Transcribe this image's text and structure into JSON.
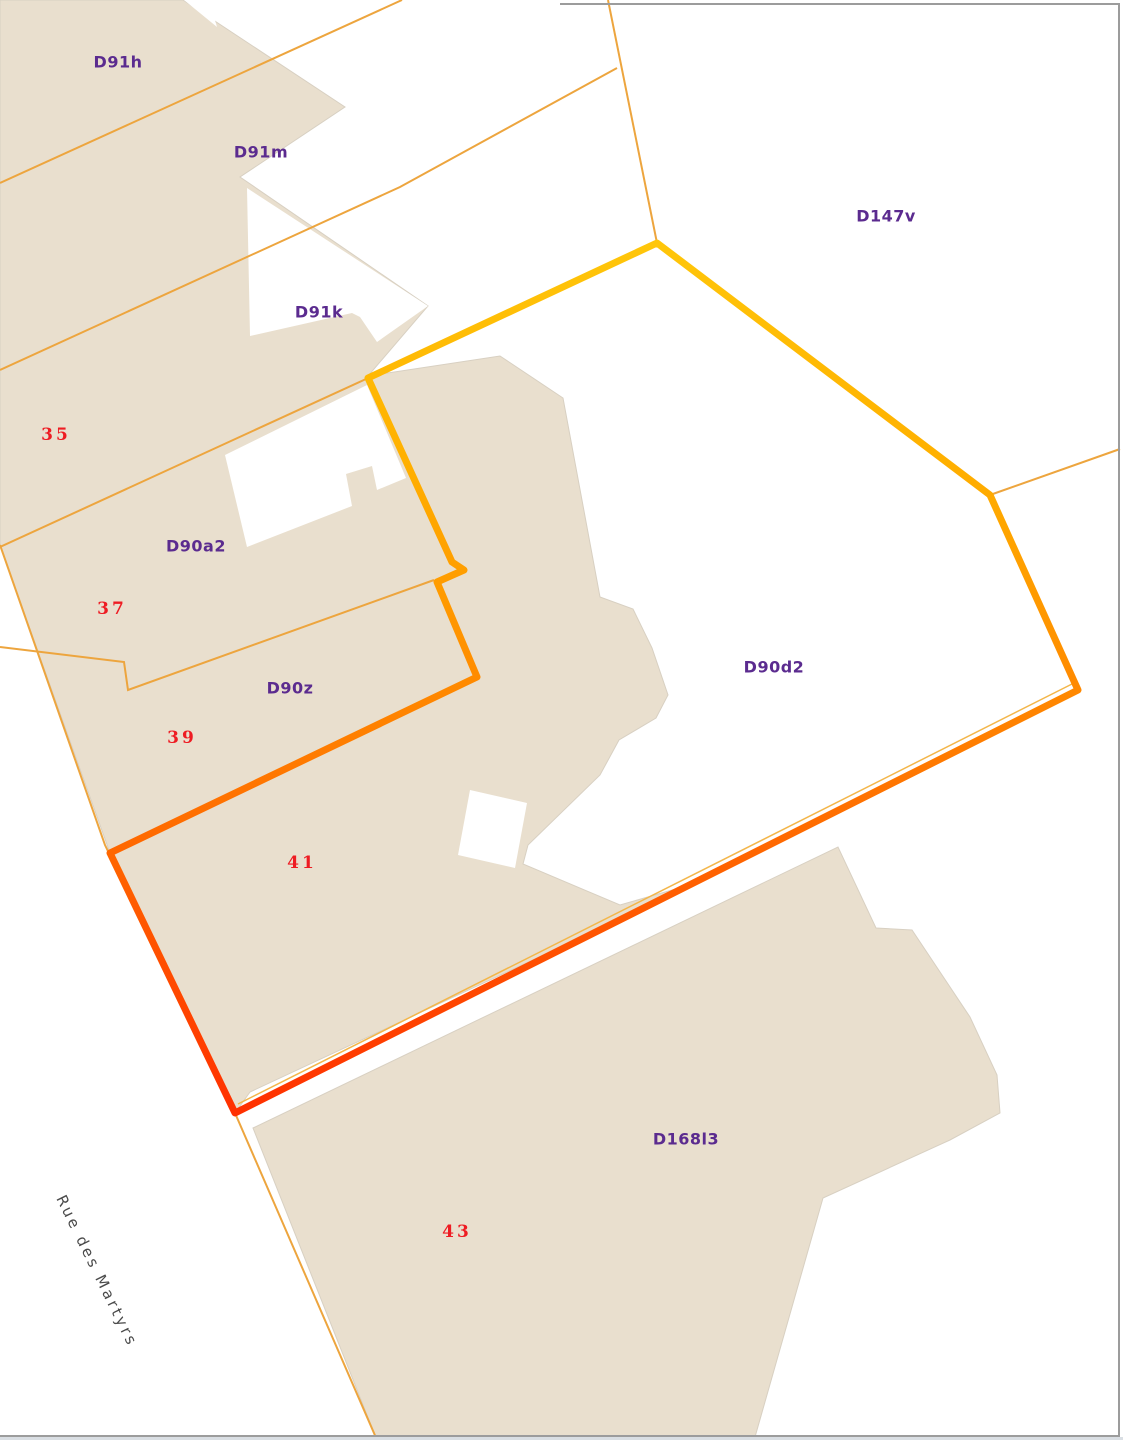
{
  "map": {
    "type": "cadastral-parcel-map",
    "street": {
      "name": "Rue des Martyrs"
    },
    "selected_parcel": {
      "id": "D90d2",
      "house_number": "41"
    },
    "parcel_labels": [
      {
        "id": "D91h",
        "x": 118,
        "y": 62
      },
      {
        "id": "D91m",
        "x": 261,
        "y": 152
      },
      {
        "id": "D91k",
        "x": 319,
        "y": 312
      },
      {
        "id": "D147v",
        "x": 886,
        "y": 216
      },
      {
        "id": "D90a2",
        "x": 196,
        "y": 546
      },
      {
        "id": "D90z",
        "x": 290,
        "y": 688
      },
      {
        "id": "D90d2",
        "x": 774,
        "y": 667
      },
      {
        "id": "D168l3",
        "x": 686,
        "y": 1139
      }
    ],
    "house_numbers": [
      {
        "number": "35",
        "x": 56,
        "y": 435
      },
      {
        "number": "37",
        "x": 112,
        "y": 609
      },
      {
        "number": "39",
        "x": 182,
        "y": 738
      },
      {
        "number": "41",
        "x": 302,
        "y": 863
      },
      {
        "number": "43",
        "x": 457,
        "y": 1232
      }
    ],
    "colors": {
      "background": "#FFFFFF",
      "built_area": "#E9DFCE",
      "built_area_edge": "#D8D0C2",
      "parcel_boundary": "#EDA53E",
      "selected_outline_top": "#FFC60A",
      "selected_outline_middle": "#FF9400",
      "selected_outline_bottom": "#FF3000",
      "parcel_label": "#5B2B8F",
      "house_number": "#EE1C23",
      "street_name": "#4A4A4A",
      "map_border": "#9C9C9C"
    }
  }
}
